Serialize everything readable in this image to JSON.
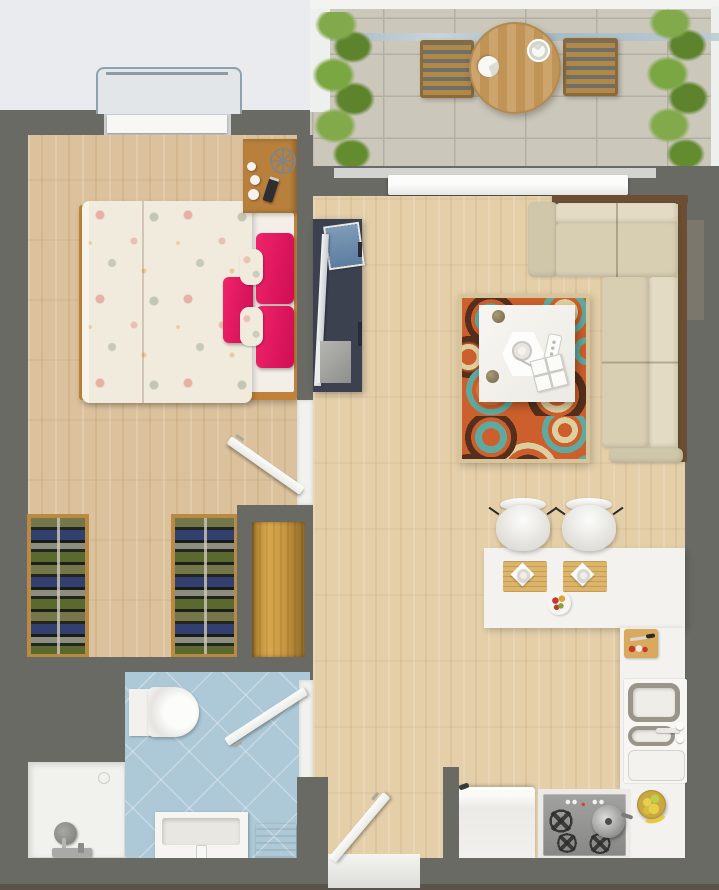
{
  "scene": {
    "type": "apartment-floor-plan-render",
    "view": "top-down 3D render",
    "description": "Top-down 3D rendered floor plan of a one-bedroom apartment with balcony, bedroom, living room, kitchen and bathroom"
  },
  "palette": {
    "bg": "#e9ebee",
    "wall": "#696a63",
    "wallDark": "#5a5349",
    "white": "#f4f4f1",
    "wood": "#dcc29c",
    "woodLiving": "#e4cfa9",
    "entryWood": "#c8963e",
    "tile": "#cbc7bb",
    "tileLine": "#b3afa2",
    "bath": "#adc9d7",
    "pink": "#e5185e",
    "duvet": "#f0ebdd",
    "bedFrame": "#c08238",
    "sofaSeat": "#d8cfb3",
    "sofaBack": "#e3dbc4",
    "sofaArm": "#d0c7ab",
    "sofaFrame": "#6b4e33",
    "tvStand": "#3c4150",
    "rugOrange": "#cd5f2c",
    "rugTeal": "#5fa99e",
    "rugCream": "#decfa0",
    "rugBrown": "#552f1b",
    "wardrobeWood": "#b98a43",
    "plant1": "#83a94e",
    "plant2": "#5e8230",
    "counter": "#f3f2ee",
    "stove": "#939391",
    "railGlass": "#a3b8c4"
  },
  "rooms": [
    {
      "id": "balcony",
      "label": "Balcony",
      "items": [
        "glass-railing",
        "plant-left",
        "plant-right",
        "outdoor-chair-left",
        "outdoor-chair-right",
        "round-table",
        "napkin-plate-1",
        "napkin-plate-2",
        "sliding-door"
      ]
    },
    {
      "id": "bedroom",
      "label": "Bedroom",
      "items": [
        "window",
        "double-bed",
        "floral-duvet",
        "pink-pillows",
        "bolster-pillows",
        "nightstand",
        "wheel-decor",
        "candles",
        "phone",
        "wardrobe-left",
        "wardrobe-right",
        "bedroom-door"
      ]
    },
    {
      "id": "living-room",
      "label": "Living room",
      "items": [
        "tv-cabinet",
        "tv",
        "magazines",
        "corner-sofa",
        "patterned-rug",
        "coffee-table",
        "hex-tray",
        "remote-control",
        "storage-box"
      ]
    },
    {
      "id": "kitchen",
      "label": "Kitchen",
      "items": [
        "breakfast-counter",
        "bar-chair-1",
        "bar-chair-2",
        "placemat-1",
        "placemat-2",
        "serving-plate",
        "cutting-board",
        "double-sink",
        "faucet",
        "fruit-bowl",
        "gas-stove",
        "cooking-pot",
        "refrigerator"
      ]
    },
    {
      "id": "bathroom",
      "label": "Bathroom",
      "items": [
        "toilet",
        "shower-tray",
        "shower-mixer",
        "washbasin-vanity",
        "wooden-step",
        "bathroom-door"
      ]
    },
    {
      "id": "entrance",
      "label": "Entrance",
      "items": [
        "entrance-door",
        "entry-wood-panel"
      ]
    }
  ]
}
